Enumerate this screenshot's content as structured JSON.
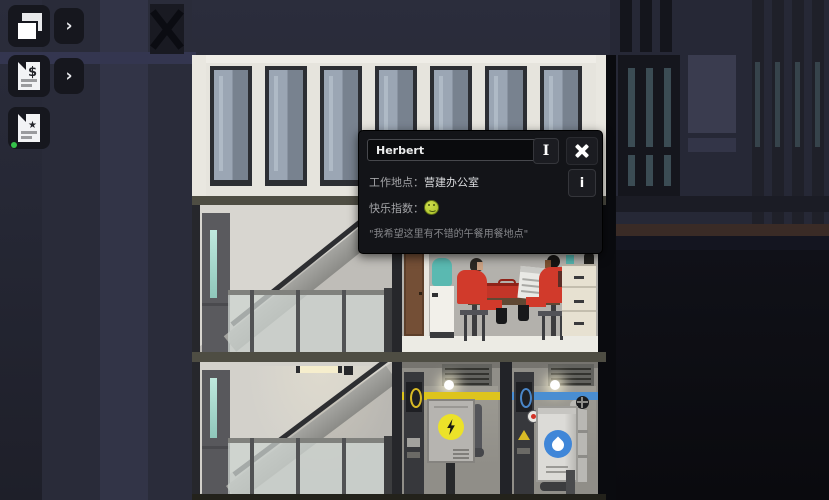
{
  "toolbar": {
    "buttons": [
      {
        "name": "layers-panel",
        "glyph": "",
        "chevron": "›"
      },
      {
        "name": "finance-report",
        "glyph": "$",
        "chevron": "›"
      },
      {
        "name": "goals-report",
        "glyph": "★",
        "notification_dot": true
      }
    ]
  },
  "tooltip": {
    "name_field": {
      "value": "Herbert"
    },
    "rename_button": {
      "glyph": "I"
    },
    "work_row": {
      "label": "工作地点：",
      "value": "营建办公室"
    },
    "info_button": {
      "glyph": "i"
    },
    "happiness_row": {
      "label": "快乐指数："
    },
    "quote": "\"我希望这里有不错的午餐用餐地点\""
  },
  "icons": {
    "layers": "two-overlapping-pages",
    "finance_doc": "document-with-dollar",
    "goals_doc": "document-with-star",
    "rename": "text-cursor-ibeam",
    "close": "x-cross",
    "info": "letter-i",
    "happiness": "green-smiley-face",
    "electrical": "lightning-bolt-in-yellow-circle",
    "water": "white-droplet-in-blue-circle",
    "notification": "green-dot"
  },
  "colors": {
    "worker_red": "#d13a2b",
    "electric_yellow": "#ddc41d",
    "water_blue": "#4a8ed2",
    "happiness_green": "#b5cd37",
    "notification_green": "#35c24a",
    "night_navy": "#262836"
  }
}
